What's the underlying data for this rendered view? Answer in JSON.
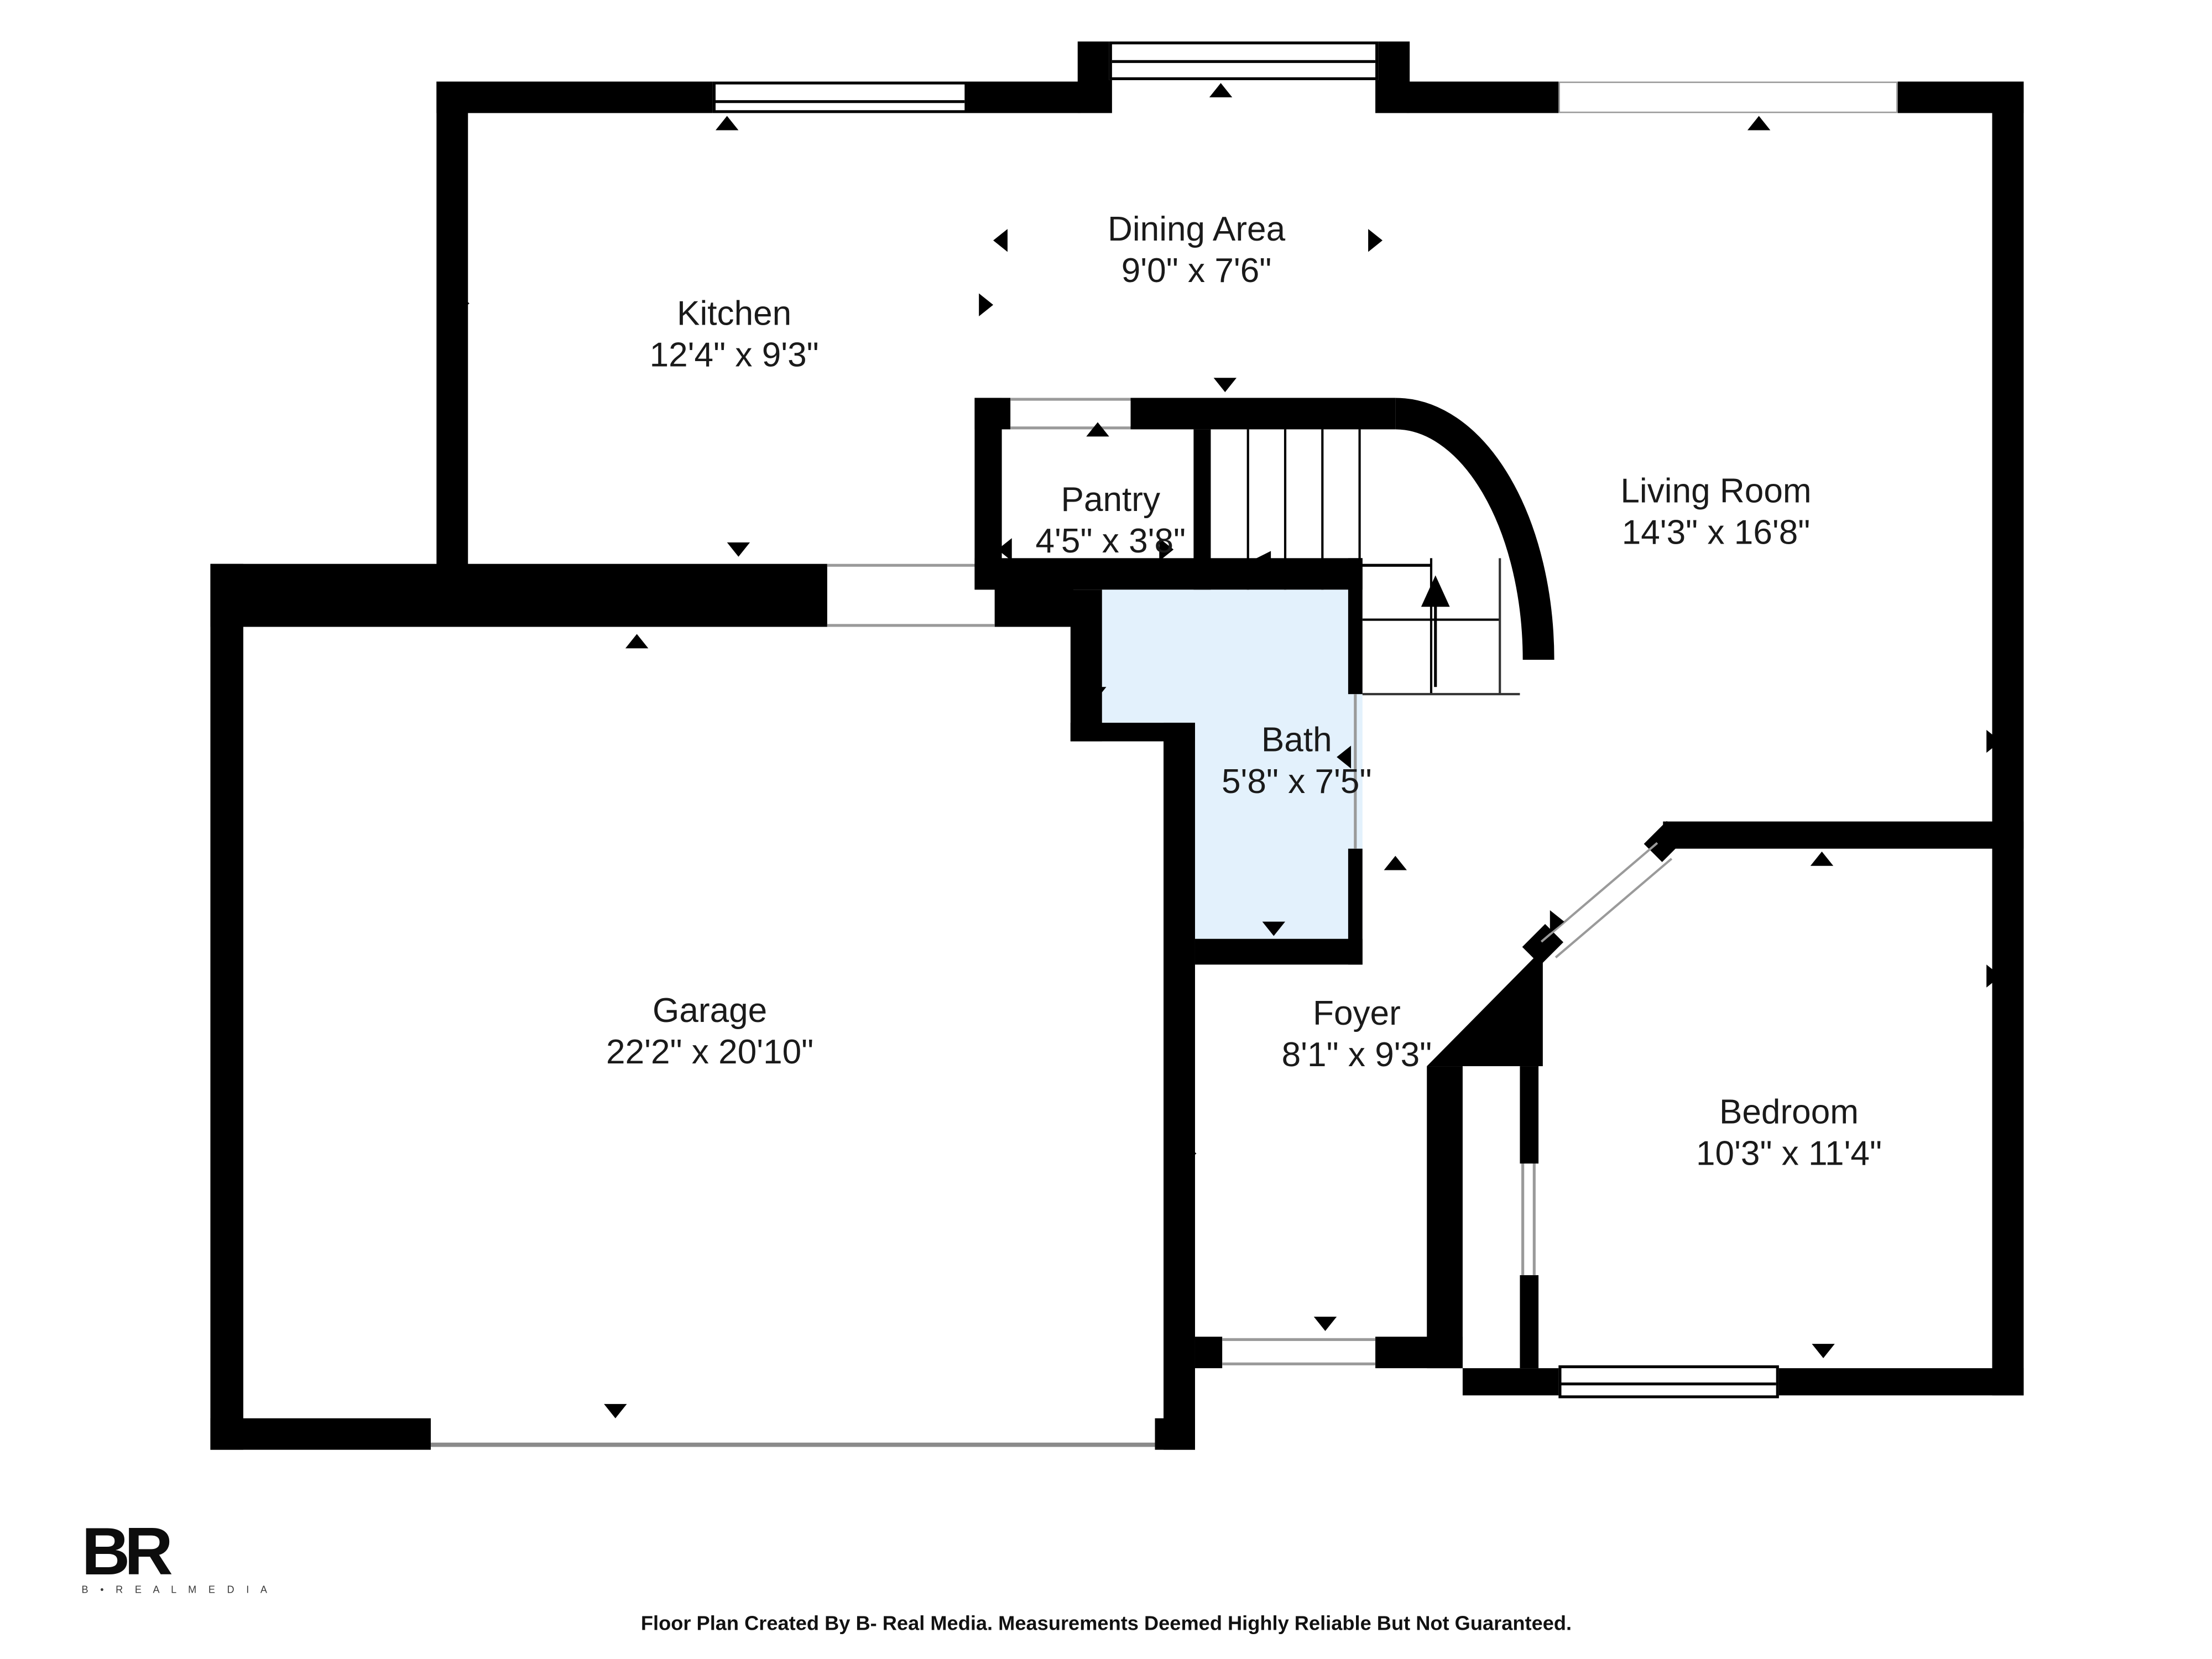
{
  "colors": {
    "wall": "#000000",
    "line": "#9a9a9a",
    "bath": "#e3f1fc",
    "text": "#1a1a1a"
  },
  "rooms": {
    "dining": {
      "name": "Dining Area",
      "dims": "9'0\" x 7'6\""
    },
    "kitchen": {
      "name": "Kitchen",
      "dims": "12'4\" x 9'3\""
    },
    "pantry": {
      "name": "Pantry",
      "dims": "4'5\" x 3'8\""
    },
    "living": {
      "name": "Living Room",
      "dims": "14'3\" x 16'8\""
    },
    "bath": {
      "name": "Bath",
      "dims": "5'8\" x 7'5\""
    },
    "garage": {
      "name": "Garage",
      "dims": "22'2\" x 20'10\""
    },
    "foyer": {
      "name": "Foyer",
      "dims": "8'1\" x 9'3\""
    },
    "bedroom": {
      "name": "Bedroom",
      "dims": "10'3\" x 11'4\""
    }
  },
  "logo": {
    "mark": "BR",
    "subtext": "B • R E A L   M E D I A"
  },
  "footer": {
    "text": "Floor Plan Created By B- Real Media. Measurements Deemed Highly Reliable But Not Guaranteed."
  }
}
